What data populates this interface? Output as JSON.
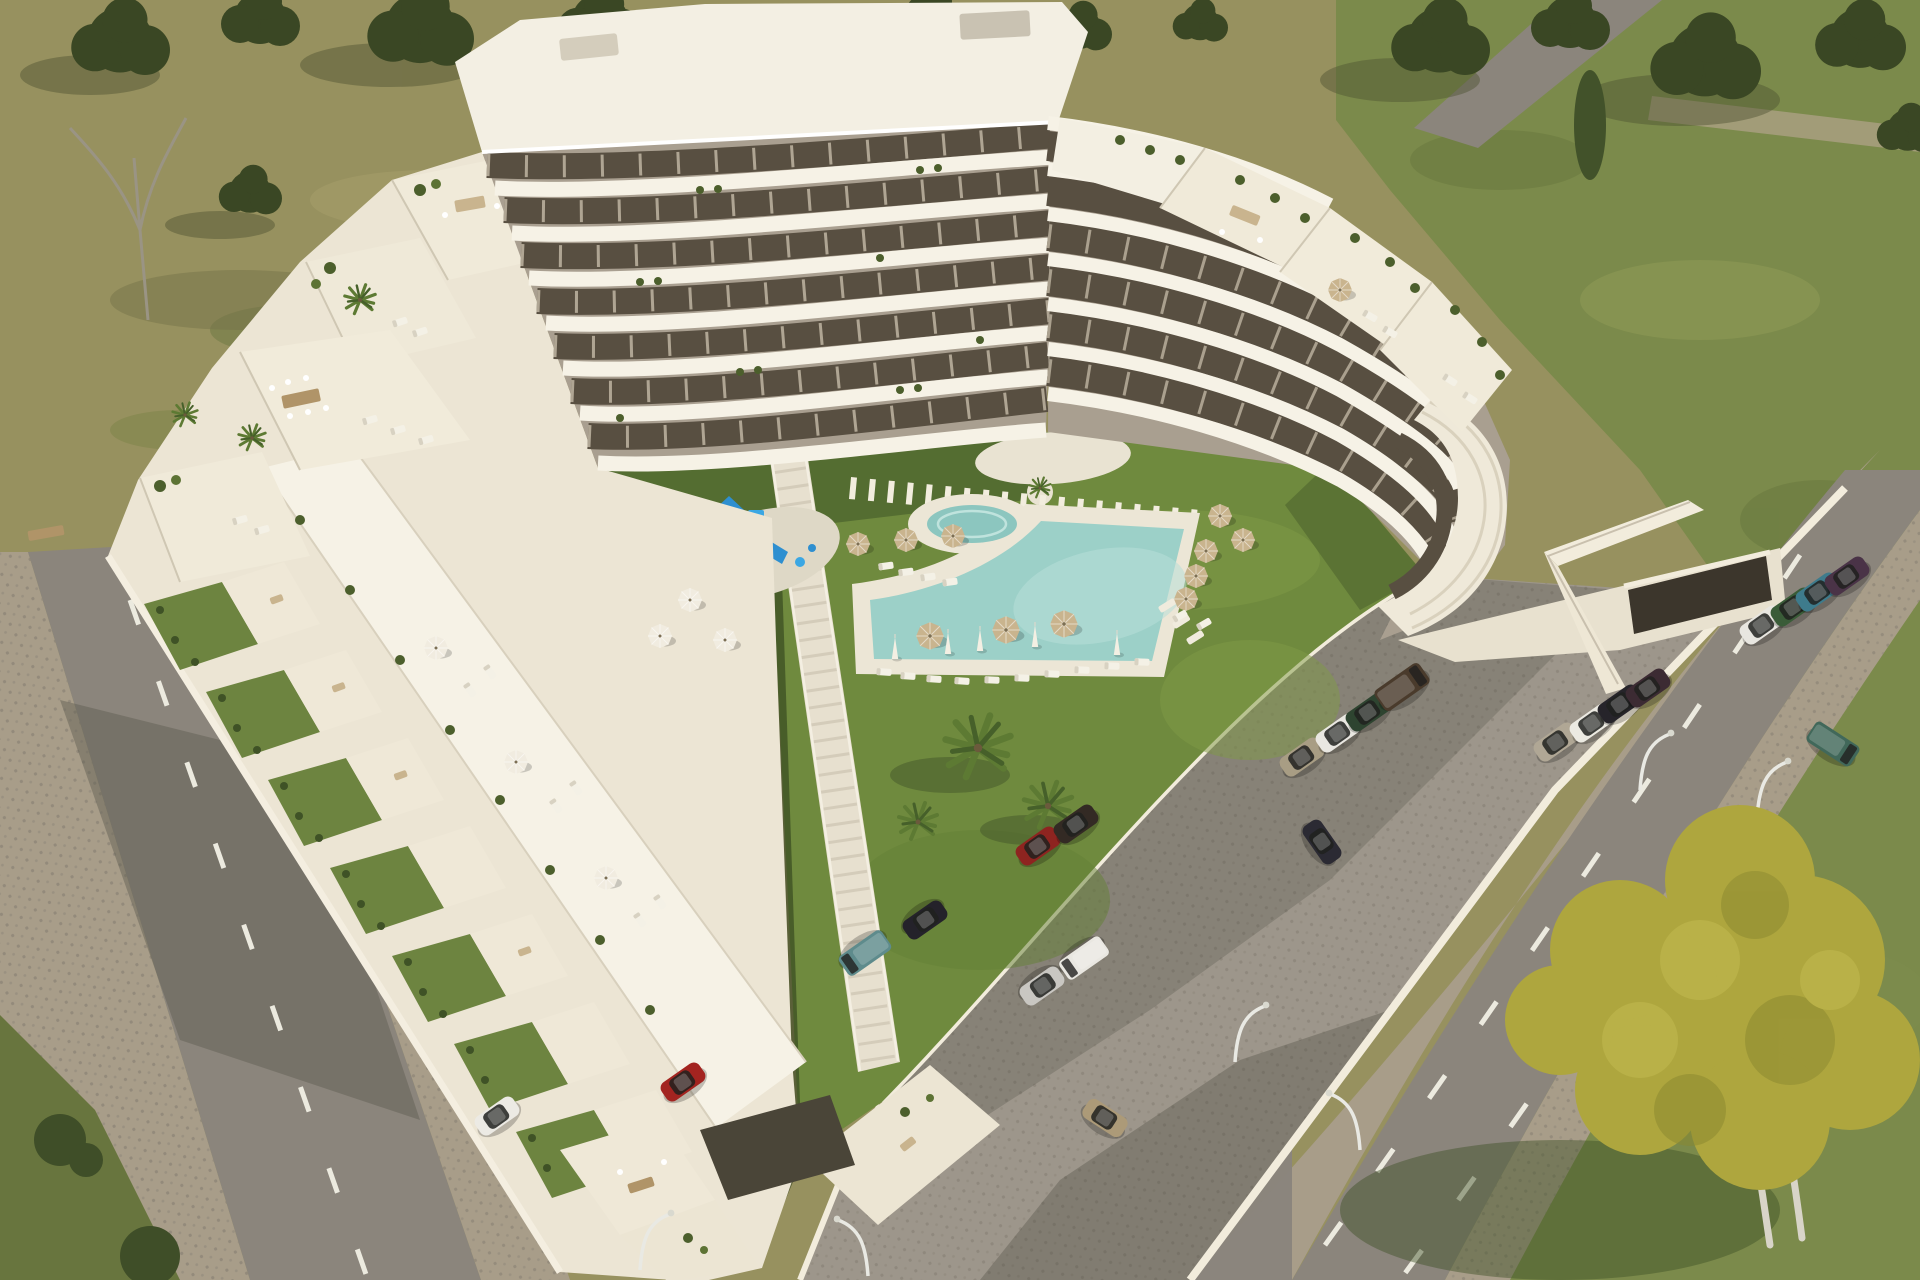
{
  "meta": {
    "domain": "Natural-Image",
    "description": "Aerial 3D architectural render of a white terraced apartment complex with wavy stacked balconies, a central courtyard with L-shaped turquoise pool, lawn, playground, cobbled parking lot with cars, and tree-lined streets",
    "width": 1920,
    "height": 1280,
    "lighting": "bright midday sun, shadows cast toward lower-left"
  },
  "palette": {
    "field_dry": "#97915f",
    "field_green": "#7b8a4b",
    "grass_verge": "#68753e",
    "lawn": "#6f8a3e",
    "lawn_shadow": "#283818",
    "tree_dark": "#3a4724",
    "tree_autumn": "#aea63e",
    "pool_water": "#9cd0c8",
    "spa_water": "#8cc6bf",
    "pool_deck": "#ece6d6",
    "building_cream": "#ece5d4",
    "building_slab": "#f6f2e6",
    "facade_taupe": "#a99f90",
    "window_dark": "#584f41",
    "parking_surface": "#9d968b",
    "asphalt": "#8b857c",
    "sidewalk": "#a89d89",
    "wall_white": "#f2ecdc",
    "umbrella_tan": "#c9b48e",
    "playground_blue": "#3ba7e3"
  },
  "scene": {
    "building": {
      "style": "modern resort apartment block, horseshoe plan, stepped terraces",
      "floors_max": 8,
      "balconies": "continuous wavy white balcony bands with glass rails",
      "roof": "flat white",
      "terraces": "stepped roof terraces with planters, umbrellas, loungers and dining sets",
      "garage": "dark underground garage entrance with white access ramp on the right base"
    },
    "courtyard": {
      "lawn": "large green communal lawn",
      "pool": {
        "shape": "L-shaped with curved inner corner",
        "water": "turquoise",
        "deck": "white stone"
      },
      "spa": {
        "shape": "round jacuzzi beside pool"
      },
      "plaza": "oval white plaza on upper lawn",
      "paths": [
        "white stepping-stone path across lawn",
        "stepped white walkway along left edge"
      ],
      "playground": {
        "equipment": [
          "blue climbing tower with canopy",
          "blue slide"
        ],
        "pad": "light circular pad"
      }
    },
    "parking": {
      "surface": "grey cobblestone",
      "perimeter": "low white wall",
      "rows": "angled parked cars inside lot and along street bays"
    },
    "roads": [
      {
        "position": "left edge, diagonal",
        "marking": "white dashed centre line",
        "sides": "cobbled sidewalks"
      },
      {
        "position": "bottom-right, diagonal",
        "marking": "two white dashed lane lines",
        "traffic": "gold car and green van driving"
      },
      {
        "position": "top-right access road through field",
        "marking": "none"
      }
    ],
    "vegetation": {
      "background": "dry olive field with dark green trees at top",
      "right": "green meadow with tree clusters and a poplar",
      "bottom_right": "large autumn-yellow tree with twin white trunks",
      "courtyard_palms": 3,
      "terrace_planters": "green shrubs along balcony edges"
    }
  },
  "inventory": {
    "umbrellas": {
      "tan_open": 14,
      "white_folded": 5,
      "white_open": 6
    },
    "sun_loungers": 30,
    "street_lamps": 6,
    "cars": [
      {
        "color": "white",
        "hex": "#e8e6e0",
        "location": "street bay near garage"
      },
      {
        "color": "green",
        "hex": "#3a5c38",
        "location": "street bay near garage"
      },
      {
        "color": "teal",
        "hex": "#3e7b8c",
        "location": "street bay near garage"
      },
      {
        "color": "maroon",
        "hex": "#4a3347",
        "location": "street bay near garage"
      },
      {
        "color": "beige",
        "hex": "#b0a795",
        "location": "lot row by wall"
      },
      {
        "color": "white",
        "hex": "#eceae2",
        "location": "lot row by wall"
      },
      {
        "color": "black",
        "hex": "#26242a",
        "location": "lot row by wall"
      },
      {
        "color": "dark maroon",
        "hex": "#3c2b33",
        "location": "lot row by wall"
      },
      {
        "color": "beige",
        "hex": "#a89d84",
        "location": "middle lot row"
      },
      {
        "color": "white",
        "hex": "#e9e7e1",
        "location": "middle lot row"
      },
      {
        "color": "dark green",
        "hex": "#2e4430",
        "location": "middle lot row"
      },
      {
        "color": "brown SUV",
        "hex": "#4a3b2c",
        "location": "middle lot row"
      },
      {
        "color": "red",
        "hex": "#8e2420",
        "location": "pair by lawn wall"
      },
      {
        "color": "dark brown",
        "hex": "#332a24",
        "location": "pair by lawn wall"
      },
      {
        "color": "teal 4x4",
        "hex": "#5e8b8c",
        "location": "centre of lot"
      },
      {
        "color": "black",
        "hex": "#24222a",
        "location": "centre of lot"
      },
      {
        "color": "silver",
        "hex": "#c9c7c2",
        "location": "centre of lot"
      },
      {
        "color": "white SUV",
        "hex": "#e9e7e1",
        "location": "centre of lot"
      },
      {
        "color": "red hatchback",
        "hex": "#a32420",
        "location": "bottom-left of lot"
      },
      {
        "color": "white",
        "hex": "#eceae4",
        "location": "bottom-left bay"
      },
      {
        "color": "dark blue",
        "hex": "#2b2a33",
        "location": "lot corner"
      },
      {
        "color": "gold",
        "hex": "#ac9a78",
        "location": "driving on bottom road"
      },
      {
        "color": "green van",
        "hex": "#41685a",
        "location": "driving on right road"
      }
    ]
  }
}
